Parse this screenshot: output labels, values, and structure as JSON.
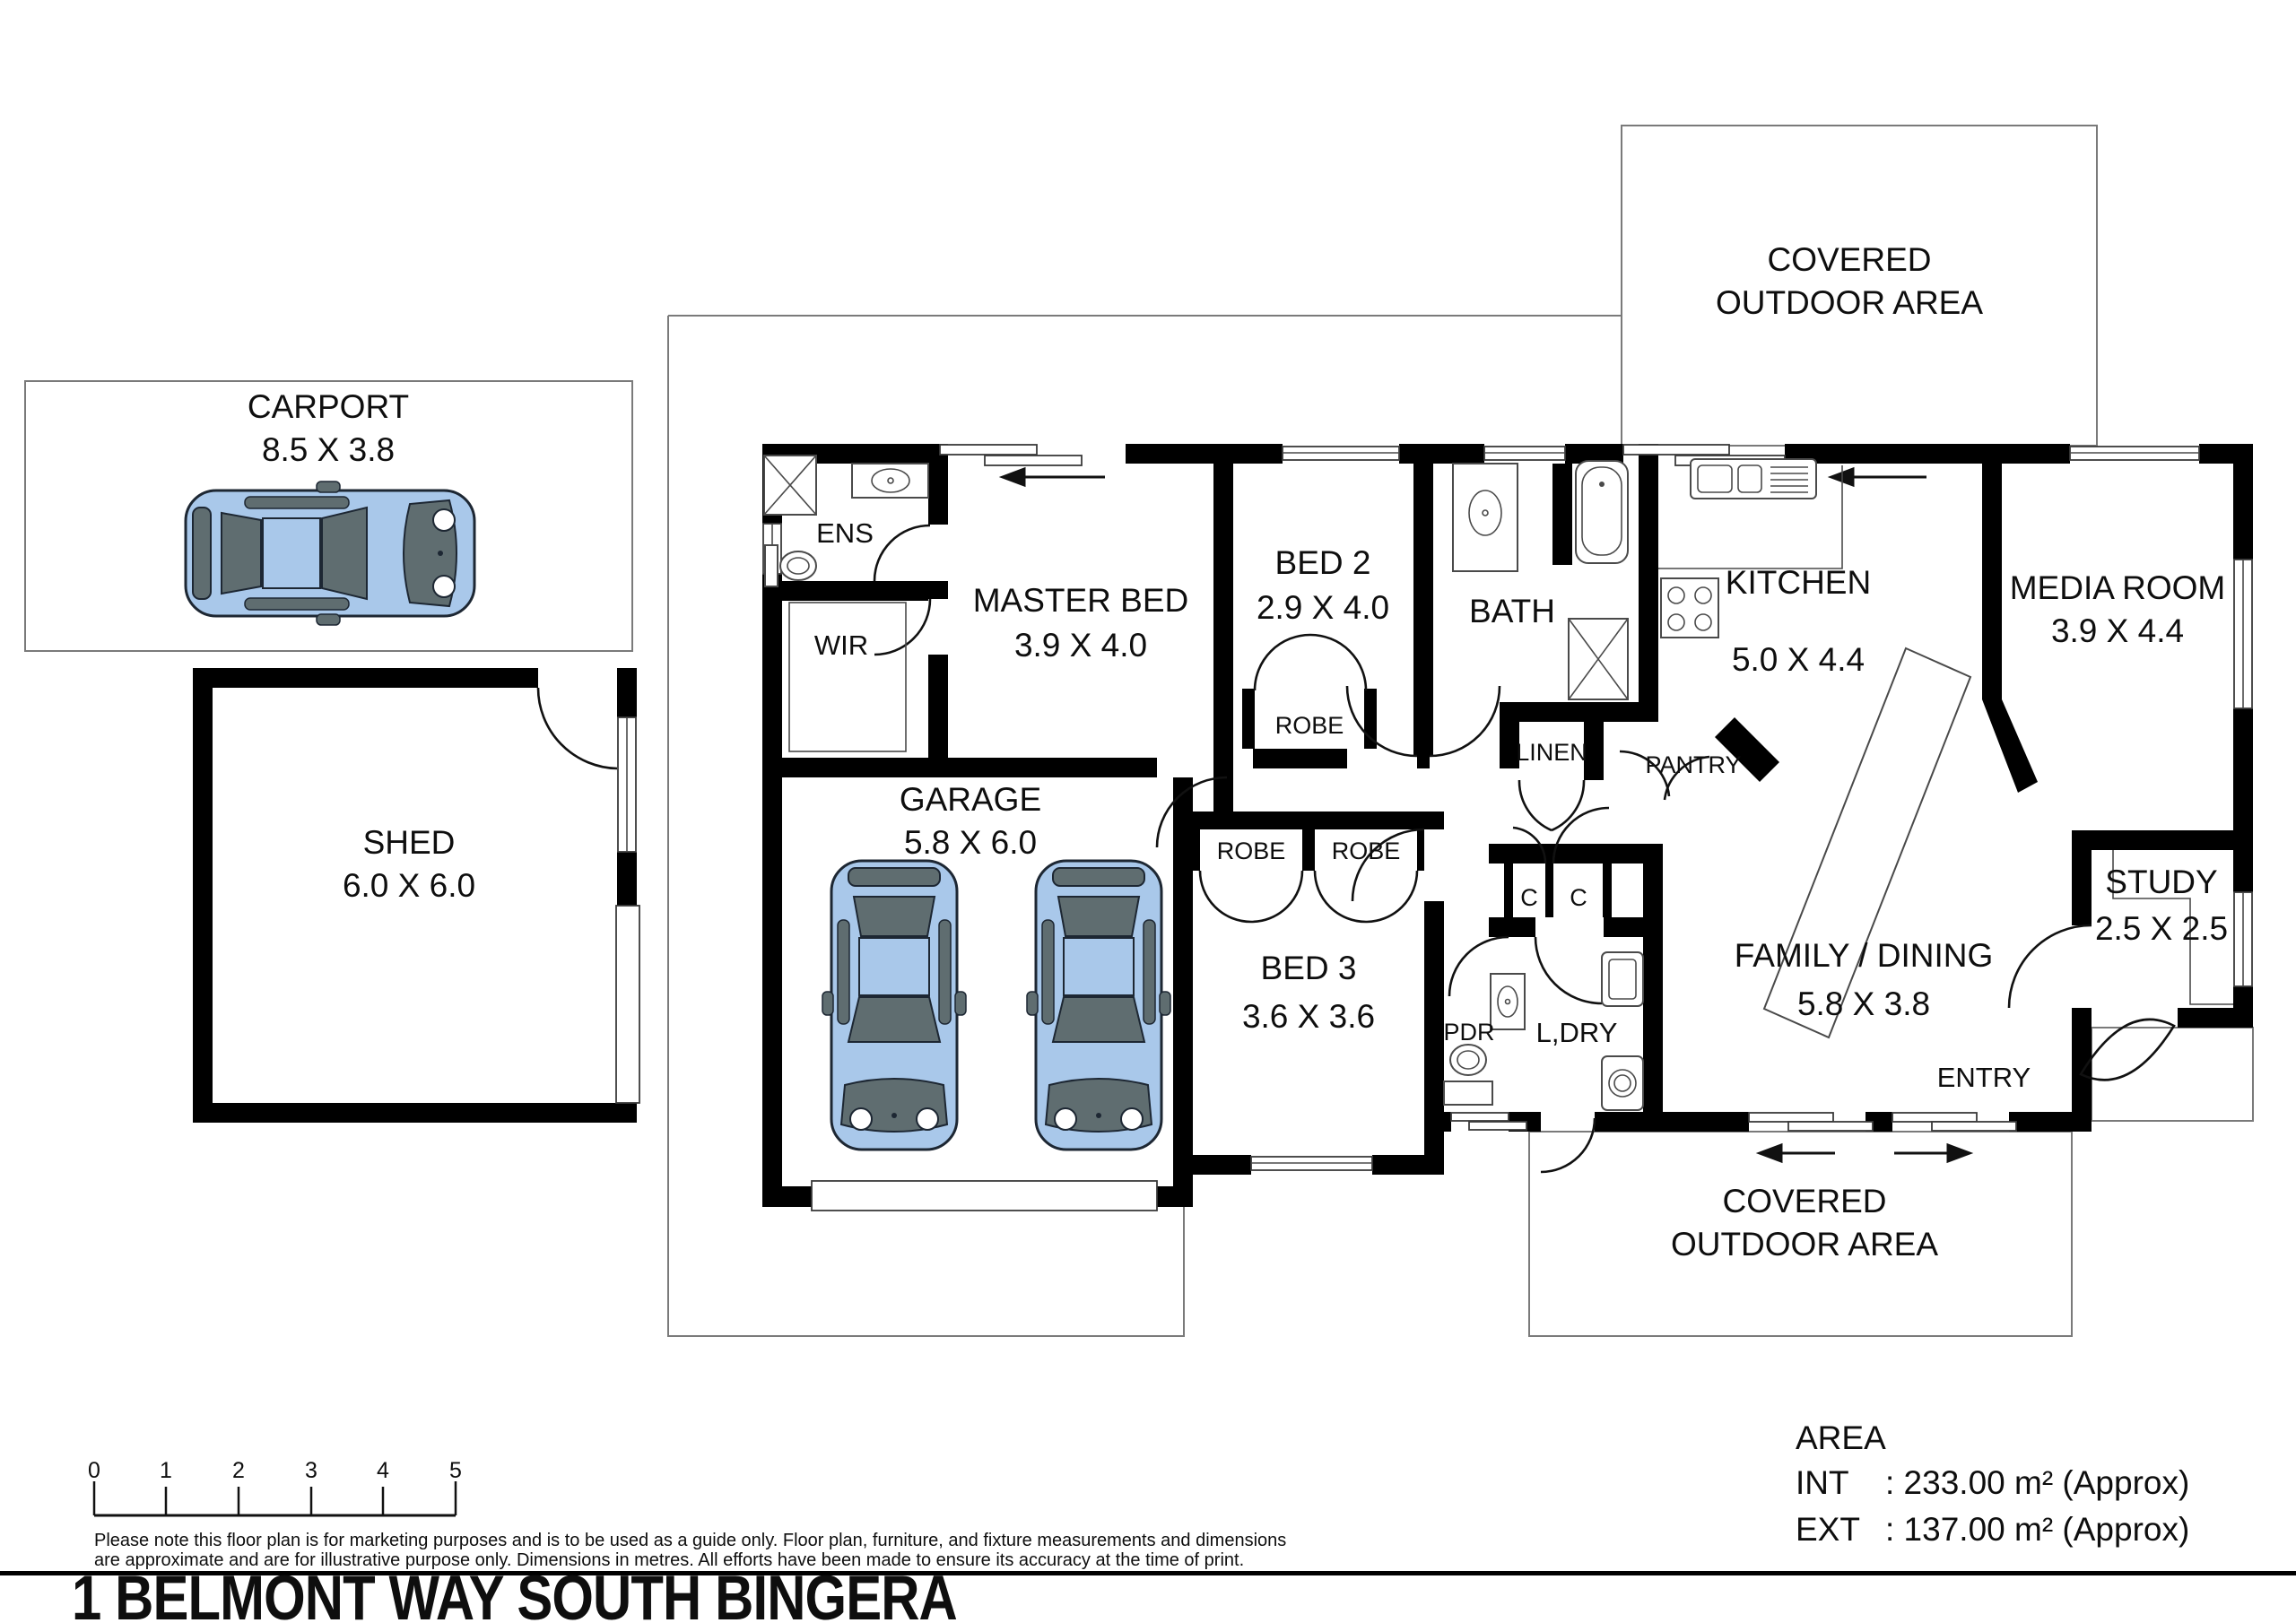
{
  "title": "1 BELMONT WAY SOUTH BINGERA",
  "covered_top": {
    "line1": "COVERED",
    "line2": "OUTDOOR AREA"
  },
  "covered_bottom": {
    "line1": "COVERED",
    "line2": "OUTDOOR AREA"
  },
  "rooms": {
    "carport": {
      "name": "CARPORT",
      "dims": "8.5 X 3.8"
    },
    "shed": {
      "name": "SHED",
      "dims": "6.0 X 6.0"
    },
    "garage": {
      "name": "GARAGE",
      "dims": "5.8 X 6.0"
    },
    "master": {
      "name": "MASTER BED",
      "dims": "3.9 X 4.0"
    },
    "bed2": {
      "name": "BED 2",
      "dims": "2.9 X 4.0"
    },
    "bed3": {
      "name": "BED 3",
      "dims": "3.6 X 3.6"
    },
    "bath": {
      "name": "BATH"
    },
    "kitchen": {
      "name": "KITCHEN",
      "dims": "5.0 X 4.4"
    },
    "media": {
      "name": "MEDIA ROOM",
      "dims": "3.9 X 4.4"
    },
    "family": {
      "name": "FAMILY / DINING",
      "dims": "5.8 X 3.8"
    },
    "study": {
      "name": "STUDY",
      "dims": "2.5 X 2.5"
    },
    "entry": {
      "name": "ENTRY"
    }
  },
  "labels": {
    "ens": "ENS",
    "wir": "WIR",
    "robe": "ROBE",
    "linen": "LINEN",
    "pantry": "PANTRY",
    "pdr": "PDR",
    "ldry": "L,DRY",
    "cupboard": "C"
  },
  "area": {
    "heading": "AREA",
    "int_label": "INT",
    "int_value": ": 233.00 m² (Approx)",
    "ext_label": "EXT",
    "ext_value": ": 137.00 m² (Approx)"
  },
  "scale": {
    "ticks": [
      "0",
      "1",
      "2",
      "3",
      "4",
      "5"
    ]
  },
  "disclaimer": {
    "line1": "Please note this floor plan is for marketing purposes and is to be used as a guide only. Floor plan, furniture, and fixture measurements and dimensions",
    "line2": "are approximate and are for illustrative purpose only. Dimensions in metres. All efforts have been made to ensure its accuracy at the time of print."
  }
}
